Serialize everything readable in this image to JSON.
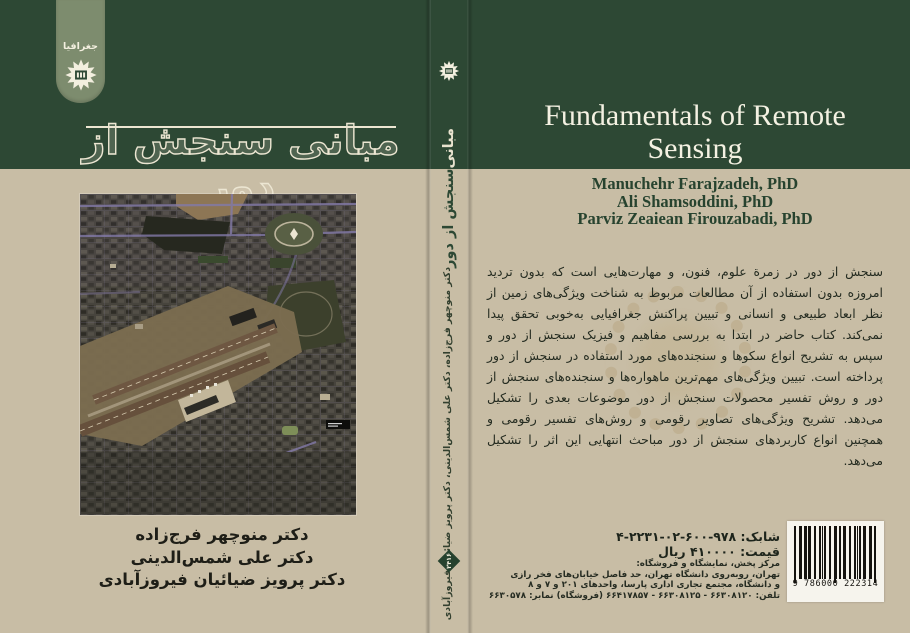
{
  "front_cover": {
    "category_label": "جغرافیا",
    "title_fa": "مبانی سنجش از دور",
    "authors_fa": [
      "دکتر منوچهر فرج‌زاده",
      "دکتر علی شمس‌الدینی",
      "دکتر پرویز ضیائیان فیروزآبادی"
    ],
    "cover_image": "satellite-photo-of-tehran-mehrabad-airport"
  },
  "spine": {
    "title_word_top": "مبانی",
    "title_word_rest": "سنجش از دور",
    "authors_fa": "دکتر منوچهر فرج‌زاده، دکتر علی شمس‌الدینی، دکتر پرویز ضیائیان فیروزآبادی",
    "book_number": "۲۴۱۶",
    "publisher_logo": "samt-starburst-logo"
  },
  "back_cover": {
    "title_en": "Fundamentals of Remote Sensing",
    "title_lines": [
      "Fundamentals of Remote",
      "Sensing"
    ],
    "authors_en": [
      "Manuchehr Farajzadeh, PhD",
      "Ali Shamsoddini, PhD",
      "Parviz Zeaiean Firouzabadi, PhD"
    ],
    "summary_fa": "سنجش از دور در زمرة علوم، فنون، و مهارت‌هایی است که بدون تردید امروزه بدون استفاده از آن مطالعات مربوط به شناخت ویژگی‌های زمین از نظر ابعاد طبیعی و انسانی و تبیین پراکنش جغرافیایی به‌خوبی تحقق پیدا نمی‌کند. کتاب حاضر در ابتدا به بررسی مفاهیم و فیزیک سنجش از دور و سپس به تشریح انواع سکوها و سنجنده‌های مورد استفاده در سنجش از دور پرداخته است. تبیین ویژگی‌های مهم‌ترین ماهواره‌ها و سنجنده‌های سنجش از دور و روش تفسیر محصولات سنجش از دور موضوعات بعدی را تشکیل می‌دهد. تشریح ویژگی‌های تصاویر رقومی و روش‌های تفسیر رقومی و همچنین انواع کاربردهای سنجش از دور مباحث انتهایی این اثر را تشکیل می‌دهد.",
    "isbn_line": "شابک: ۹۷۸-۶۰۰-۰۲-۲۲۳۱-۴",
    "price_line": "قیمت: ۴۱۰۰۰۰ ریال",
    "distribution_lines": [
      "مرکز پخش، نمایشگاه و فروشگاه:",
      "تهران، روبه‌روی دانشگاه تهران، حد فاصل خیابان‌های فخر رازی",
      "و دانشگاه، مجتمع تجاری اداری پارسا، واحدهای ۲۰۱ و ۷ و ۸",
      "تلفن: ۶۶۳۰۸۱۲۰ - ۶۶۳۰۸۱۲۵ - ۶۶۴۱۷۸۵۷ (فروشگاه)   نمابر: ۶۶۳۰۵۷۸"
    ],
    "barcode_digits": "9 786000 222314"
  },
  "colors": {
    "band_green": "#2d4834",
    "cover_beige": "#c8bda5",
    "tab_green": "#7d8c6e",
    "cream_text": "#ece6d2",
    "dark_green_text": "#27432f"
  }
}
